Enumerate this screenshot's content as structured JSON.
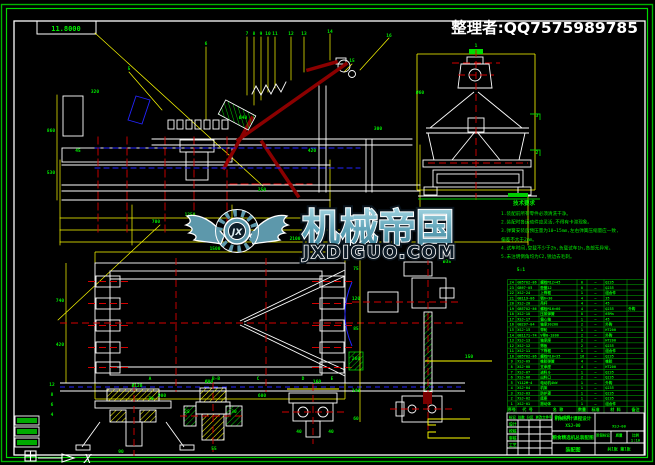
{
  "header": {
    "curator": "整理者:QQ7575989785"
  },
  "watermark": {
    "brand": "机械帝国",
    "domain": "JXDIGUO.COM",
    "monogram": "JX",
    "teal": "#64a7bb",
    "dark": "#0e1c28"
  },
  "frame": {
    "corner_label": "11.8000"
  },
  "colors": {
    "line_green": "#00c800",
    "text_green": "#00ee00",
    "dim_yellow": "#ffff00",
    "geom_white": "#ffffff",
    "center_red": "#d40000",
    "part_maroon": "#8b0000",
    "accent_blue": "#2424ff"
  },
  "notes": {
    "title": "技术要求",
    "lines": [
      "1.装配前所有零件必须清洗干净。",
      "2.装配时各运动件应灵活,不得有卡滞现象。",
      "3.弹簧安装后预压量为10~15mm,左右弹簧压缩量应一致,",
      "  偏差不大于2mm。",
      "4.试车时间,空载不少于2h,负载试车1h,各部无异常。",
      "5.未注明倒角均为C2,锐边去毛刺。"
    ]
  },
  "bom": {
    "headers": [
      "序号",
      "代  号",
      "名  称",
      "数量",
      "标准",
      "材  料",
      "备注"
    ],
    "rows": [
      [
        "24",
        "GB5782-86",
        "螺栓M12×45",
        "8",
        "—",
        "Q235",
        ""
      ],
      [
        "23",
        "GB97-85",
        "垫圈12",
        "8",
        "—",
        "Q235",
        ""
      ],
      [
        "22",
        "XSJ-24",
        "上筛框",
        "1",
        "—",
        "组合件",
        ""
      ],
      [
        "21",
        "GB119-86",
        "销6×30",
        "4",
        "—",
        "35",
        ""
      ],
      [
        "20",
        "XSJ-20",
        "吊杆",
        "4",
        "—",
        "45",
        ""
      ],
      [
        "19",
        "GB5782-86",
        "螺栓M16×60",
        "4",
        "—",
        "Q235",
        "外购"
      ],
      [
        "18",
        "XSJ-18",
        "压紧弹簧",
        "8",
        "—",
        "65Mn",
        ""
      ],
      [
        "17",
        "XSJ-17",
        "偏心轴",
        "1",
        "—",
        "45",
        ""
      ],
      [
        "16",
        "GB297-84",
        "轴承30208",
        "2",
        "—",
        "外购",
        ""
      ],
      [
        "15",
        "XSJ-15",
        "带轮",
        "1",
        "—",
        "HT200",
        ""
      ],
      [
        "14",
        "GB1171-74",
        "V带B-1800",
        "2",
        "—",
        "外购",
        ""
      ],
      [
        "13",
        "XSJ-13",
        "轴承座",
        "2",
        "—",
        "HT200",
        ""
      ],
      [
        "12",
        "XSJ-12",
        "筛板",
        "2",
        "—",
        "Q235",
        ""
      ],
      [
        "11",
        "XSJ-11",
        "下筛框",
        "1",
        "—",
        "组合件",
        ""
      ],
      [
        "10",
        "GB5782-86",
        "螺栓M10×35",
        "16",
        "—",
        "Q235",
        ""
      ],
      [
        "9",
        "XSJ-09",
        "橡胶弹簧",
        "4",
        "—",
        "橡胶",
        ""
      ],
      [
        "8",
        "XSJ-08",
        "支承座",
        "4",
        "—",
        "HT200",
        ""
      ],
      [
        "7",
        "XSJ-07",
        "进料斗",
        "1",
        "—",
        "Q235",
        ""
      ],
      [
        "6",
        "XSJ-06",
        "出料口",
        "2",
        "—",
        "Q235",
        ""
      ],
      [
        "5",
        "Y112M-4",
        "电动机4kW",
        "1",
        "—",
        "外购",
        ""
      ],
      [
        "4",
        "XSJ-04",
        "机架",
        "1",
        "—",
        "Q235",
        ""
      ],
      [
        "3",
        "XSJ-03",
        "防护罩",
        "1",
        "—",
        "Q235",
        ""
      ],
      [
        "2",
        "XSJ-02",
        "底座",
        "1",
        "—",
        "Q235",
        ""
      ],
      [
        "1",
        "XSJ-01",
        "振动体",
        "1",
        "—",
        "组合件",
        ""
      ]
    ]
  },
  "title_block": {
    "revision_strip": "标记 处数 分区 更改文件号 签名 日期",
    "sign_labels": [
      "设计",
      "校核",
      "审核",
      "工艺"
    ],
    "org_line1": "机械设计课程设计",
    "org_line2": "XSJ-00",
    "title_line": "粮食精选机总装配图",
    "sheet_label": "装配图",
    "drawing_no": "XSJ-00",
    "stage_labels": [
      "阶段标记",
      "质量",
      "比例"
    ],
    "scale_value": "1:10",
    "sheet_count": "共1张 第1张"
  },
  "ucs": {
    "x_label": "X"
  },
  "labels": {
    "green": [
      {
        "x": 129,
        "y": 70,
        "t": "5"
      },
      {
        "x": 206,
        "y": 45,
        "t": "6"
      },
      {
        "x": 247,
        "y": 35,
        "t": "7"
      },
      {
        "x": 254,
        "y": 35,
        "t": "8"
      },
      {
        "x": 261,
        "y": 35,
        "t": "9"
      },
      {
        "x": 268,
        "y": 35,
        "t": "10"
      },
      {
        "x": 275,
        "y": 35,
        "t": "11"
      },
      {
        "x": 291,
        "y": 35,
        "t": "12"
      },
      {
        "x": 304,
        "y": 35,
        "t": "13"
      },
      {
        "x": 330,
        "y": 33,
        "t": "14"
      },
      {
        "x": 352,
        "y": 62,
        "t": "15"
      },
      {
        "x": 389,
        "y": 37,
        "t": "16"
      },
      {
        "x": 95,
        "y": 93,
        "t": "320"
      },
      {
        "x": 78,
        "y": 152,
        "t": "45"
      },
      {
        "x": 190,
        "y": 216,
        "t": "1250"
      },
      {
        "x": 237,
        "y": 228,
        "t": "1600"
      },
      {
        "x": 295,
        "y": 240,
        "t": "2100"
      },
      {
        "x": 51,
        "y": 132,
        "t": "860"
      },
      {
        "x": 51,
        "y": 174,
        "t": "530"
      },
      {
        "x": 156,
        "y": 223,
        "t": "700"
      },
      {
        "x": 262,
        "y": 191,
        "t": "250"
      },
      {
        "x": 312,
        "y": 152,
        "t": "420"
      },
      {
        "x": 378,
        "y": 130,
        "t": "300"
      },
      {
        "x": 420,
        "y": 94,
        "t": "Ø60"
      },
      {
        "x": 243,
        "y": 119,
        "t": "Ø40"
      },
      {
        "x": 537,
        "y": 117,
        "t": "3"
      },
      {
        "x": 537,
        "y": 154,
        "t": "2"
      },
      {
        "x": 476,
        "y": 47,
        "t": "1"
      },
      {
        "x": 215,
        "y": 250,
        "t": "1500"
      },
      {
        "x": 162,
        "y": 397,
        "t": "900"
      },
      {
        "x": 262,
        "y": 397,
        "t": "600"
      },
      {
        "x": 60,
        "y": 302,
        "t": "740"
      },
      {
        "x": 60,
        "y": 346,
        "t": "420"
      },
      {
        "x": 150,
        "y": 380,
        "t": "A"
      },
      {
        "x": 216,
        "y": 380,
        "t": "B-B"
      },
      {
        "x": 258,
        "y": 380,
        "t": "C"
      },
      {
        "x": 303,
        "y": 380,
        "t": "D"
      },
      {
        "x": 332,
        "y": 380,
        "t": "E"
      },
      {
        "x": 356,
        "y": 270,
        "t": "75"
      },
      {
        "x": 356,
        "y": 300,
        "t": "120"
      },
      {
        "x": 356,
        "y": 330,
        "t": "85"
      },
      {
        "x": 356,
        "y": 360,
        "t": "260"
      },
      {
        "x": 356,
        "y": 392,
        "t": "140"
      },
      {
        "x": 356,
        "y": 420,
        "t": "60"
      },
      {
        "x": 447,
        "y": 263,
        "t": "Ø35"
      },
      {
        "x": 137,
        "y": 387,
        "t": "Ø120"
      },
      {
        "x": 151,
        "y": 400,
        "t": "70"
      },
      {
        "x": 121,
        "y": 453,
        "t": "90"
      },
      {
        "x": 209,
        "y": 383,
        "t": "Ø80"
      },
      {
        "x": 187,
        "y": 413,
        "t": "25"
      },
      {
        "x": 234,
        "y": 413,
        "t": "30"
      },
      {
        "x": 214,
        "y": 450,
        "t": "55"
      },
      {
        "x": 317,
        "y": 383,
        "t": "160"
      },
      {
        "x": 299,
        "y": 433,
        "t": "40"
      },
      {
        "x": 331,
        "y": 433,
        "t": "40"
      },
      {
        "x": 469,
        "y": 358,
        "t": "150"
      },
      {
        "x": 52,
        "y": 386,
        "t": "12"
      },
      {
        "x": 52,
        "y": 396,
        "t": "8"
      },
      {
        "x": 52,
        "y": 406,
        "t": "6"
      },
      {
        "x": 52,
        "y": 416,
        "t": "4"
      },
      {
        "x": 521,
        "y": 271,
        "t": "5:1"
      }
    ]
  }
}
